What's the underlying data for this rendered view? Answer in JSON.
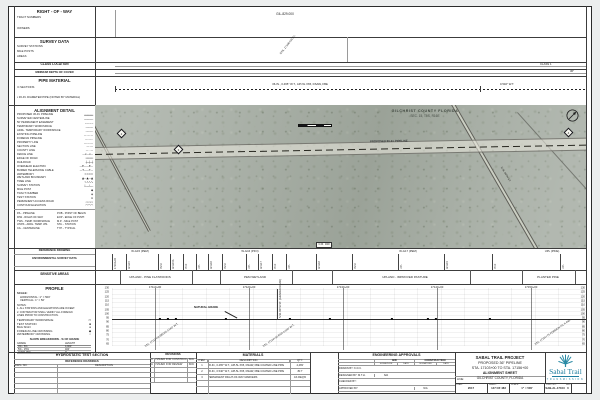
{
  "sheet": {
    "row_band": {
      "title": "RIGHT - OF - WAY",
      "fields": [
        {
          "y": 16,
          "label": "TRACT NUMBERS"
        },
        {
          "y": 27,
          "label": "OWNERS"
        }
      ],
      "tract": "GIL-829.000"
    },
    "survey_band": {
      "title": "SURVEY DATA",
      "fields": [
        {
          "y": 45,
          "label": "SURVEY STATIONS"
        },
        {
          "y": 50,
          "label": "MILE POSTS"
        },
        {
          "y": 55,
          "label": "AREAS"
        }
      ],
      "callout": "STA. 17106+00 P.I."
    },
    "class_band": {
      "title": "CLASS LOCATION",
      "value": "CLASS 1"
    },
    "depth_band": {
      "title": "MINIMUM DEPTH OF COVER",
      "value": "36\""
    },
    "pipe_band": {
      "title": "PIPE MATERIAL",
      "row1": "⊙ SECTIONS",
      "row2": "▪ 36-IN. DIAMETER PIPE (NOTED BY MATERIAL)",
      "seg1": "36-IN., 0.465\" W.T., API-5L X65, DSAW, FBE",
      "seg2": "0.540\" W.T."
    }
  },
  "alignment_detail": {
    "title": "ALIGNMENT DETAIL",
    "items": [
      {
        "label": "PROPOSED 36-IN. PIPELINE",
        "sym": "━━━━━━"
      },
      {
        "label": "SURVEYED CENTERLINE",
        "sym": "──────"
      },
      {
        "label": "50' PERMANENT EASEMENT",
        "sym": "─ ─ ─ ─"
      },
      {
        "label": "TEMPORARY WORKSPACE",
        "sym": "╌╌╌╌╌"
      },
      {
        "label": "ADDL. TEMPORARY WORKSPACE",
        "sym": "┄┄┄┄┄"
      },
      {
        "label": "EXISTING PIPELINE",
        "sym": "— — —"
      },
      {
        "label": "FOREIGN PIPELINE",
        "sym": "—··—··"
      },
      {
        "label": "PROPERTY LINE",
        "sym": "—·—·—"
      },
      {
        "label": "SECTION LINE",
        "sym": "—··—"
      },
      {
        "label": "COUNTY LINE",
        "sym": "— · —"
      },
      {
        "label": "FENCE LINE",
        "sym": "—x—x—"
      },
      {
        "label": "EDGE OF ROAD",
        "sym": "═════"
      },
      {
        "label": "RAILROAD",
        "sym": "┼─┼─┼"
      },
      {
        "label": "OVERHEAD ELECTRIC",
        "sym": "—E——E—"
      },
      {
        "label": "BURIED TELEPHONE CABLE",
        "sym": "—T——T—"
      },
      {
        "label": "WATERBODY",
        "sym": "≈≈≈≈"
      },
      {
        "label": "WETLAND BOUNDARY",
        "sym": "▲—▲—▲"
      },
      {
        "label": "TREE LINE",
        "sym": "∿∿∿∿"
      },
      {
        "label": "SURVEY STATION",
        "sym": "┴──┴──"
      },
      {
        "label": "MILE POST",
        "sym": "◆"
      },
      {
        "label": "TRACT NUMBER",
        "sym": "◈"
      },
      {
        "label": "TEST STATION",
        "sym": "⊙"
      },
      {
        "label": "PERMANENT ACCESS ROAD",
        "sym": "▭▭▭"
      },
      {
        "label": "CONTOUR ELEVATION",
        "sym": "⌒⌒⌒"
      }
    ],
    "abbr": [
      "P/L - PIPELINE",
      "R/W - RIGHT-OF-WAY",
      "TWS - TEMP. WORKSPACE",
      "ATWS - ADDL. TEMP. WS.",
      "C/L - CENTERLINE",
      "POB - POINT OF BEGIN",
      "EOP - EDGE OF PVMT.",
      "M.P. - MILE POST",
      "STA. - STATION",
      "TYP. - TYPICAL"
    ]
  },
  "map": {
    "county": "GILCHRIST COUNTY FLORIDA",
    "section": "SEC. 15, T9S, R16E",
    "pipeline_label": "PROPOSED 36-IN. PIPELINE",
    "road_chip": "C.R. 340",
    "road_name": "N.W. 60TH ST.",
    "north": "N",
    "diamonds": [
      {
        "x": 118,
        "y": 130,
        "n": "2"
      },
      {
        "x": 175,
        "y": 146,
        "n": "3"
      },
      {
        "x": 565,
        "y": 129,
        "n": "4"
      }
    ]
  },
  "ref_band": {
    "title": "REFERENCE DRAWING"
  },
  "env": {
    "title": "ENVIRONMENTAL SURVEY DATA",
    "groups": [
      {
        "x": 140,
        "label": "W-G15 (PEM)"
      },
      {
        "x": 250,
        "label": "W-G16 (PFO)"
      },
      {
        "x": 408,
        "label": "W-G17 (PEM)"
      },
      {
        "x": 552,
        "label": "UPL (PINE)"
      }
    ],
    "ticks": [
      {
        "x": 112,
        "label": "17104+60"
      },
      {
        "x": 126,
        "label": "W-G15"
      },
      {
        "x": 158,
        "label": "PEM"
      },
      {
        "x": 170,
        "label": "W-G15A"
      },
      {
        "x": 183,
        "label": "PFO"
      },
      {
        "x": 196,
        "label": "UPL"
      },
      {
        "x": 208,
        "label": "W-G16"
      },
      {
        "x": 222,
        "label": "PEM"
      },
      {
        "x": 246,
        "label": "UPL"
      },
      {
        "x": 258,
        "label": "W-G17"
      },
      {
        "x": 272,
        "label": "PFO"
      },
      {
        "x": 286,
        "label": "UPL"
      },
      {
        "x": 316,
        "label": "W-G18"
      },
      {
        "x": 352,
        "label": "PEM"
      },
      {
        "x": 398,
        "label": "UPL"
      },
      {
        "x": 444,
        "label": "W-G19"
      },
      {
        "x": 492,
        "label": "PFO"
      },
      {
        "x": 560,
        "label": "UPL"
      }
    ]
  },
  "sensitive": {
    "title": "SENSITIVE AREAS",
    "labels": [
      {
        "x": 150,
        "label": "UPLAND - PINE FLATWOODS"
      },
      {
        "x": 255,
        "label": "PEM WETLAND"
      },
      {
        "x": 405,
        "label": "UPLAND - IMPROVED PASTURE"
      },
      {
        "x": 548,
        "label": "PLANTED PINE"
      }
    ],
    "ticks": [
      {
        "x": 120
      },
      {
        "x": 192
      },
      {
        "x": 220
      },
      {
        "x": 292
      },
      {
        "x": 332
      },
      {
        "x": 470
      },
      {
        "x": 522
      },
      {
        "x": 575
      }
    ]
  },
  "profile": {
    "title": "PROFILE",
    "scale_label": "SCALE:",
    "scale_h": "HORIZONTAL: 1\" = 500'",
    "scale_v": "VERTICAL: 1\" = 50'",
    "notes": [
      "NOTES:",
      "1. ALL STATIONS AND ELEVATIONS ARE IN FEET.",
      "2. CONTRACTOR SHALL VERIFY ALL FOREIGN",
      "    LINES PRIOR TO CONSTRUCTION."
    ],
    "legend": [
      {
        "label": "TEMPORARY WORKSPACE",
        "sym": "▭"
      },
      {
        "label": "TEST STATION",
        "sym": "■"
      },
      {
        "label": "BAG SIGN",
        "sym": "●"
      },
      {
        "label": "FOREIGN LINE CROSSING",
        "sym": "◆"
      },
      {
        "label": "WATERBODY CROSSING",
        "sym": "○"
      }
    ],
    "slope": {
      "title": "SLOPE BREAKDOWN - % OF GRADE",
      "col1": "GRADE",
      "col2": "LENGTH",
      "rows": [
        {
          "grade": "0% - 5%",
          "len": "4,900'"
        },
        {
          "grade": "5% - 15%",
          "len": "400'"
        },
        {
          "grade": "OVER 15%",
          "len": "0'"
        }
      ]
    },
    "grade_label": "NATURAL GRADE",
    "vcallout": "N.W. 60TH ST. (GRADED ROAD)",
    "elevations": [
      {
        "y": 288,
        "v": "130"
      },
      {
        "y": 292.3,
        "v": "125"
      },
      {
        "y": 296.6,
        "v": "120"
      },
      {
        "y": 300.9,
        "v": "115"
      },
      {
        "y": 305.2,
        "v": "110"
      },
      {
        "y": 309.5,
        "v": "105"
      },
      {
        "y": 313.8,
        "v": "100"
      },
      {
        "y": 318.1,
        "v": "95"
      },
      {
        "y": 322.4,
        "v": "90"
      },
      {
        "y": 326.7,
        "v": "85"
      },
      {
        "y": 331,
        "v": "80"
      },
      {
        "y": 335.3,
        "v": "75"
      },
      {
        "y": 339.6,
        "v": "70"
      },
      {
        "y": 343.9,
        "v": "65"
      }
    ],
    "stations": [
      {
        "x": 155,
        "label": "17110+00"
      },
      {
        "x": 249,
        "label": "17120+00"
      },
      {
        "x": 343,
        "label": "17130+00"
      },
      {
        "x": 437,
        "label": "17140+00"
      },
      {
        "x": 531,
        "label": "17150+00"
      }
    ],
    "markers": [
      {
        "x": 160
      },
      {
        "x": 168
      },
      {
        "x": 176
      },
      {
        "x": 226
      },
      {
        "x": 290
      },
      {
        "x": 330
      },
      {
        "x": 392
      },
      {
        "x": 428
      },
      {
        "x": 436
      },
      {
        "x": 490
      }
    ],
    "callouts": [
      {
        "x": 146,
        "y": 345,
        "t": "STA. 17111+50  BEGIN 0.540\" W.T."
      },
      {
        "x": 264,
        "y": 345,
        "t": "STA. 17124+00  END 0.540\" W.T."
      },
      {
        "x": 536,
        "y": 343,
        "t": "STA. 17151+75  FOREIGN P/L X-ING"
      }
    ]
  },
  "hydro": {
    "title": "HYDROSTATIC TEST SECTION",
    "ref_title": "REFERENCE DRAWINGS",
    "col1": "DWG. NO.",
    "col2": "DESCRIPTION",
    "rows": [
      {
        "no": "",
        "desc": ""
      },
      {
        "no": "",
        "desc": ""
      },
      {
        "no": "",
        "desc": ""
      },
      {
        "no": "",
        "desc": ""
      },
      {
        "no": "",
        "desc": ""
      }
    ]
  },
  "revisions": {
    "title": "REVISIONS",
    "rows": [
      {
        "no": "0",
        "desc": "ISSUED FOR CONSTRUCTION",
        "by": "KDC"
      },
      {
        "no": "A",
        "desc": "ISSUED FOR REVIEW",
        "by": "KDC"
      },
      {
        "no": "",
        "desc": "",
        "by": ""
      },
      {
        "no": "",
        "desc": "",
        "by": ""
      },
      {
        "no": "",
        "desc": "",
        "by": ""
      }
    ]
  },
  "materials": {
    "title": "MATERIALS",
    "col_item": "ITEM",
    "col_desc": "DESCRIPTION",
    "col_qty": "QTY.",
    "rows": [
      {
        "item": "1",
        "desc": "36-IN., 0.465\" W.T., API-5L X65, DSAW, FBE COATED LINE PIPE",
        "qty": "4,483'"
      },
      {
        "item": "2",
        "desc": "36-IN., 0.540\" W.T., API-5L X65, DSAW, FBE COATED LINE PIPE",
        "qty": "817'"
      },
      {
        "item": "3",
        "desc": "PERMANENT RIGHT-OF-WAY MARKERS",
        "qty": "AS REQ'D"
      },
      {
        "item": "",
        "desc": "",
        "qty": ""
      }
    ]
  },
  "approvals": {
    "title": "ENGINEERING APPROVALS",
    "bid": "BID",
    "construction": "CONSTRUCTION",
    "sig": "SIGNATURE",
    "date": "DATE",
    "rows": [
      {
        "title": "DRAWN BY: K.D.C.",
        "bs": "",
        "bd": "",
        "cs": "",
        "cd": ""
      },
      {
        "title": "DESIGNED BY: M.T.H.",
        "bs": "N/A",
        "bd": "",
        "cs": "",
        "cd": ""
      },
      {
        "title": "CHECKED BY:",
        "bs": "",
        "bd": "",
        "cs": "",
        "cd": ""
      },
      {
        "title": "APPROVED BY:",
        "bs": "",
        "bd": "",
        "cs": "N/A",
        "cd": ""
      }
    ]
  },
  "titleblock": {
    "line1": "SABAL TRAIL PROJECT",
    "line2": "PROPOSED 36\" PIPELINE",
    "line3": "STA. 17103+00 TO STA. 17156+00",
    "line4": "ALIGNMENT SHEET",
    "line_label": "LINE:",
    "county": "GILCHRIST COUNTY, FLORIDA",
    "cells": [
      {
        "k": "YEAR:",
        "v": "2017"
      },
      {
        "k": "SHEET:",
        "v": "147 OF 483"
      },
      {
        "k": "SCALE:",
        "v": "1\" = 500'"
      },
      {
        "k": "DWG. NO.",
        "v": "SAB-AL-17103"
      },
      {
        "k": "REV.",
        "v": "0"
      }
    ]
  },
  "logo": {
    "name": "Sabal Trail",
    "sub": "TRANSMISSION",
    "color": "#2a8aa5"
  }
}
